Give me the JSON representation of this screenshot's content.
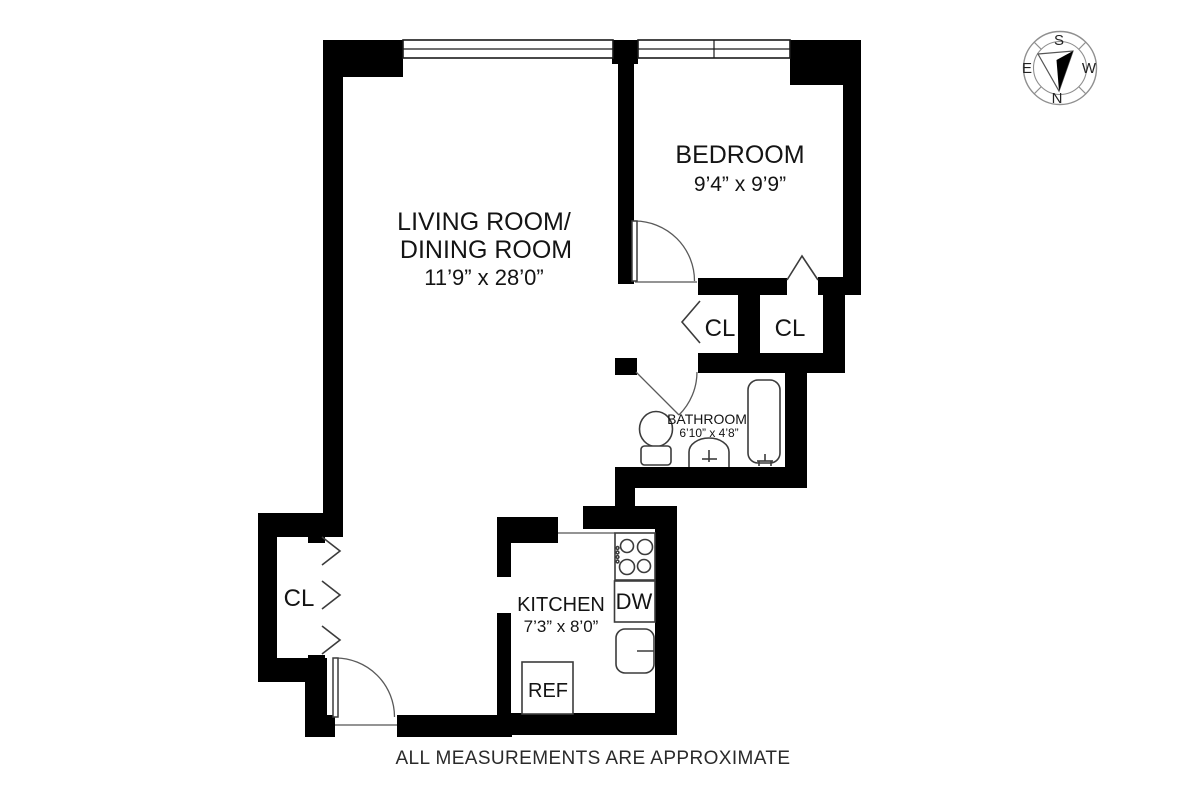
{
  "plan": {
    "rooms": {
      "living_dining": {
        "label_line1": "LIVING ROOM/",
        "label_line2": "DINING ROOM",
        "dimensions": "11’9” x 28’0”"
      },
      "bedroom": {
        "label": "BEDROOM",
        "dimensions": "9’4” x 9’9”"
      },
      "bathroom": {
        "label": "BATHROOM",
        "dimensions": "6’10” x 4’8”"
      },
      "kitchen": {
        "label": "KITCHEN",
        "dimensions": "7’3” x 8’0”"
      }
    },
    "closets": {
      "entry": "CL",
      "hall": "CL",
      "bedroom": "CL"
    },
    "appliances": {
      "dishwasher": "DW",
      "refrigerator": "REF"
    },
    "compass": {
      "top": "S",
      "bottom": "N",
      "left": "E",
      "right": "W"
    },
    "footer_disclaimer": "ALL MEASUREMENTS ARE APPROXIMATE",
    "colors": {
      "wall": "#000000",
      "fixture_outline": "#3c3c3c",
      "label_text": "#141414",
      "compass_ring": "#8f8f8f"
    }
  }
}
